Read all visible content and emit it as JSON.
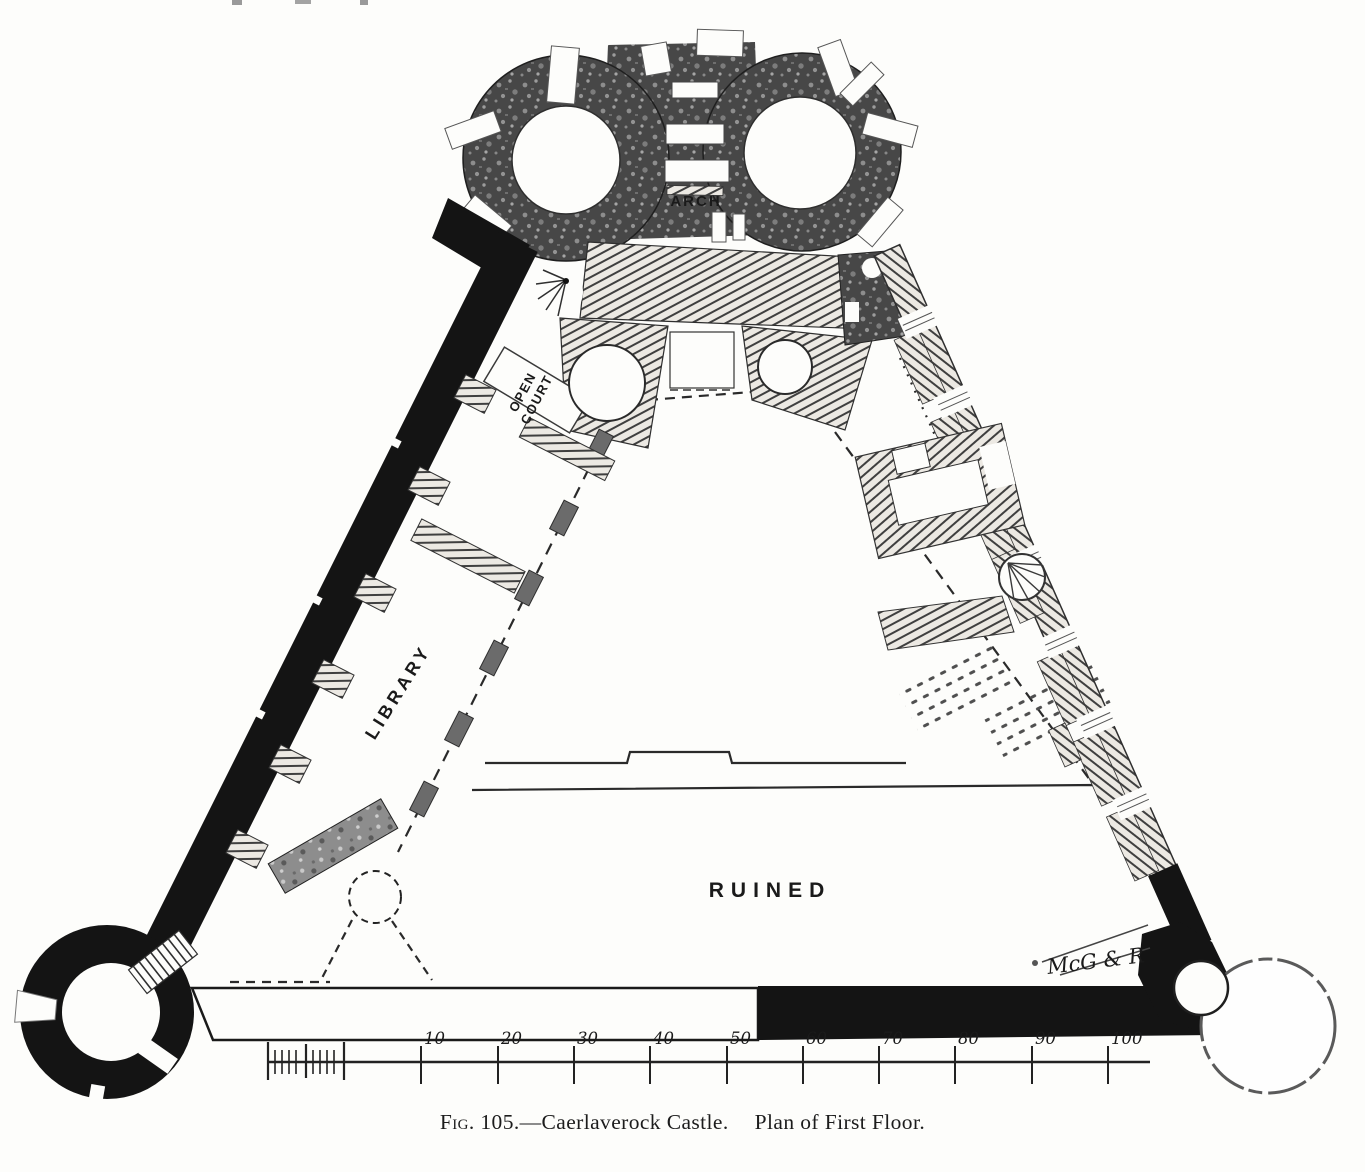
{
  "page": {
    "caption": {
      "figure_label": "Fig. 105.",
      "separator": "—",
      "title": "Caerlaverock Castle.",
      "subtitle": "Plan of First Floor."
    },
    "plan_labels": {
      "arch": "ARCH",
      "open_court_line1": "OPEN",
      "open_court_line2": "COURT",
      "library": "LIBRARY",
      "ruined": "RUINED",
      "engraver_signature": "McG & R"
    },
    "scale_bar": {
      "tick_labels": [
        "10",
        "20",
        "30",
        "40",
        "50",
        "60",
        "70",
        "80",
        "90",
        "100"
      ]
    },
    "colors": {
      "ink": "#1b1b1b",
      "paper": "#fdfdfb",
      "wall_black": "#141414"
    }
  }
}
